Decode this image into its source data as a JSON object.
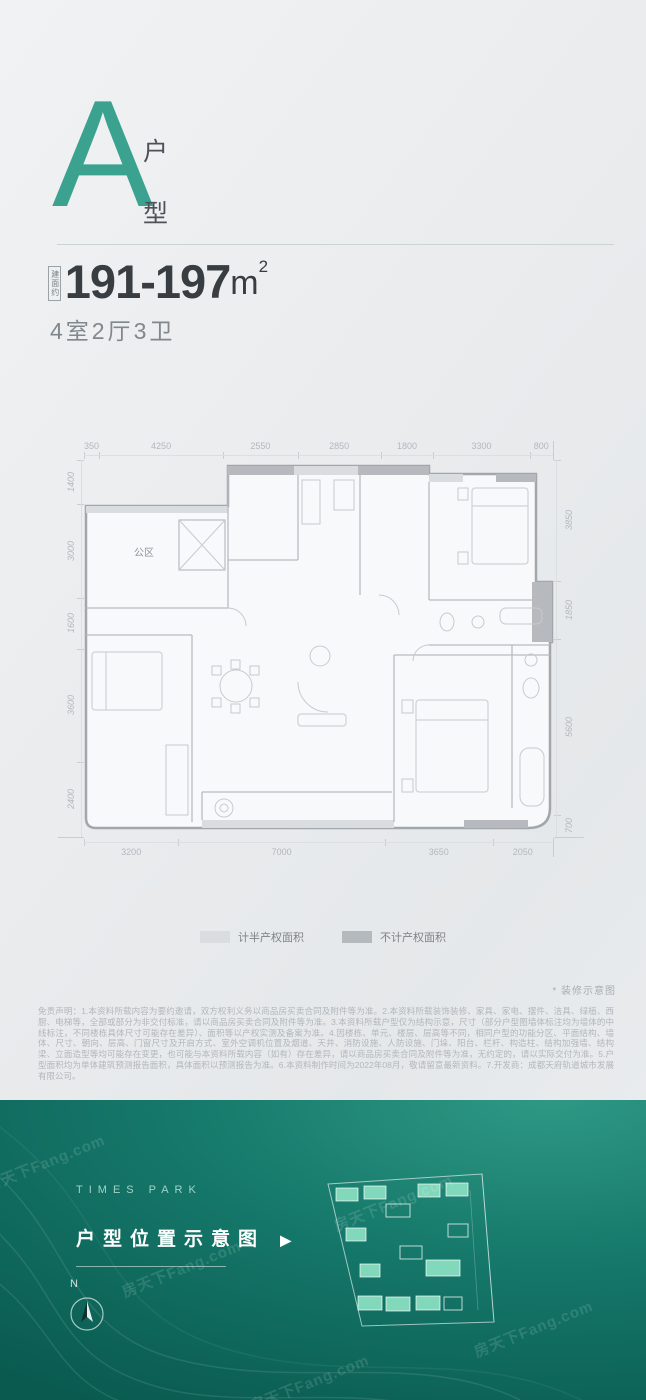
{
  "accent_color": "#3aa28e",
  "header": {
    "unit_letter": "A",
    "unit_type_top": "户",
    "unit_type_bottom": "型",
    "area_prefix": "建面约",
    "area_value": "191-197",
    "area_unit": "m",
    "area_sup": "2",
    "layout_summary": "4室2厅3卫"
  },
  "floor_plan": {
    "room_label": "公区",
    "dims_top": [
      "350",
      "4250",
      "2550",
      "2850",
      "1800",
      "3300",
      "800"
    ],
    "dims_left": [
      "1400",
      "3000",
      "1600",
      "3600",
      "2400"
    ],
    "dims_right": [
      "3850",
      "1850",
      "5600",
      "700"
    ],
    "dims_bottom": [
      "3200",
      "7000",
      "3650",
      "2050"
    ],
    "legend": [
      {
        "label": "计半产权面积",
        "color": "#d9dde0"
      },
      {
        "label": "不计产权面积",
        "color": "#b4b9bd"
      }
    ],
    "note": "* 装修示意图"
  },
  "disclaimer": "免责声明：1.本资料所载内容为要约邀请，双方权利义务以商品房买卖合同及附件等为准。2.本资料所载装饰装修、家具、家电、摆件、洁具、绿植、西厨、电梯等，全部或部分为非交付标准，请以商品房买卖合同及附件等为准。3.本资料所载户型仅为结构示意，尺寸（部分户型图墙体标注均为墙体的中线标注，不同楼栋具体尺寸可能存在差异）、面积等以产权实测及备案为准。4.因楼栋、单元、楼层、层高等不同，相同户型的功能分区、平面结构、墙体、尺寸、朝向、层高、门窗尺寸及开启方式、室外空调机位置及烟道、天井、消防设施、人防设施、门垛、阳台、栏杆、构造柱、结构加强墙、结构梁、立面造型等均可能存在变更，也可能与本资料所载内容（如有）存在差异，请以商品房买卖合同及附件等为准，无约定的，请以实际交付为准。5.户型面积均为单体建筑预测报告面积，具体面积以预测报告为准。6.本资料制作时间为2022年08月，敬请留意最新资料。7.开发商：成都天府轨道城市发展有限公司。",
  "footer": {
    "brand": "TIMES PARK",
    "map_title": "户型位置示意图",
    "arrow": "▶",
    "compass_label": "N",
    "colors": {
      "gradient_light": "#2f9885",
      "gradient_dark": "#0a5a50",
      "building_fill": "#82d8ba"
    }
  },
  "watermark": "房天下Fang.com"
}
